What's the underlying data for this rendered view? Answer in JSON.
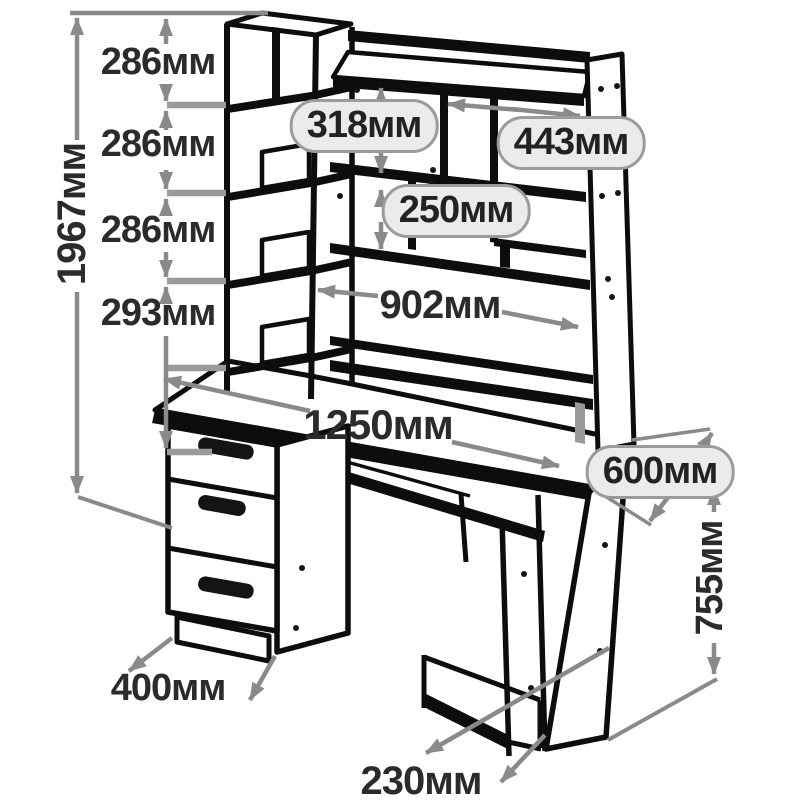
{
  "drawing": {
    "description": "Computer desk with hutch - dimension line drawing",
    "unit_suffix": "мм"
  },
  "labels": {
    "gap1": "286мм",
    "gap2": "286мм",
    "gap3": "286мм",
    "gap4": "293мм",
    "total_height": "1967мм",
    "niche_318": "318мм",
    "niche_443": "443мм",
    "niche_250": "250мм",
    "span_902": "902мм",
    "width_1250": "1250мм",
    "depth_600": "600мм",
    "desk_height_755": "755мм",
    "pedestal_depth_400": "400мм",
    "cpu_width_230": "230мм"
  },
  "colors": {
    "background": "#ffffff",
    "furniture_line": "#0d0d0d",
    "dimension_line": "#8a8a8a",
    "tick_line": "#9a9a9a",
    "label_text": "#2b2b2b",
    "pill_fill": "#ebebeb",
    "pill_border": "#9b9b9b"
  }
}
